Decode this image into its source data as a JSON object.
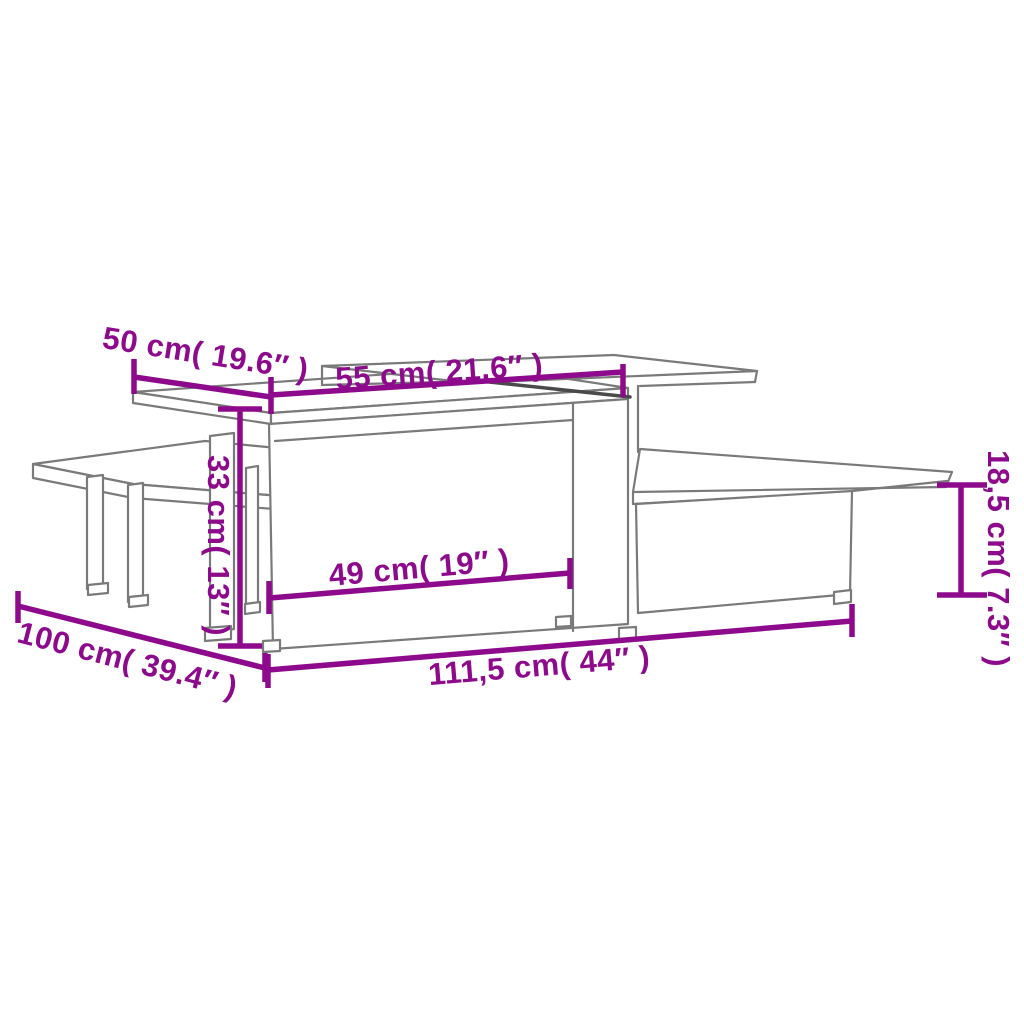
{
  "page": {
    "kind": "furniture-dimension-line-drawing",
    "background": "#ffffff"
  },
  "colors": {
    "annotation": "#8D0A8C",
    "drawing_line": "#7a7a7a",
    "drawing_line_dark": "#4a4a4a"
  },
  "dimensions": {
    "top_depth": {
      "label": "50 cm( 19.6″ )",
      "cm": "50",
      "inches": "19.6"
    },
    "upper_top_width": {
      "label": "55 cm( 21.6″ )",
      "cm": "55",
      "inches": "21.6"
    },
    "tall_section_height": {
      "label": "33 cm( 13″ )",
      "cm": "33",
      "inches": "13"
    },
    "inner_width": {
      "label": "49 cm( 19″ )",
      "cm": "49",
      "inches": "19"
    },
    "total_depth": {
      "label": "100 cm( 39.4″ )",
      "cm": "100",
      "inches": "39.4"
    },
    "total_width": {
      "label": "111,5 cm( 44″ )",
      "cm": "111,5",
      "inches": "44"
    },
    "low_section_height": {
      "label": "18,5 cm( 7.3″ )",
      "cm": "18,5",
      "inches": "7.3"
    }
  }
}
